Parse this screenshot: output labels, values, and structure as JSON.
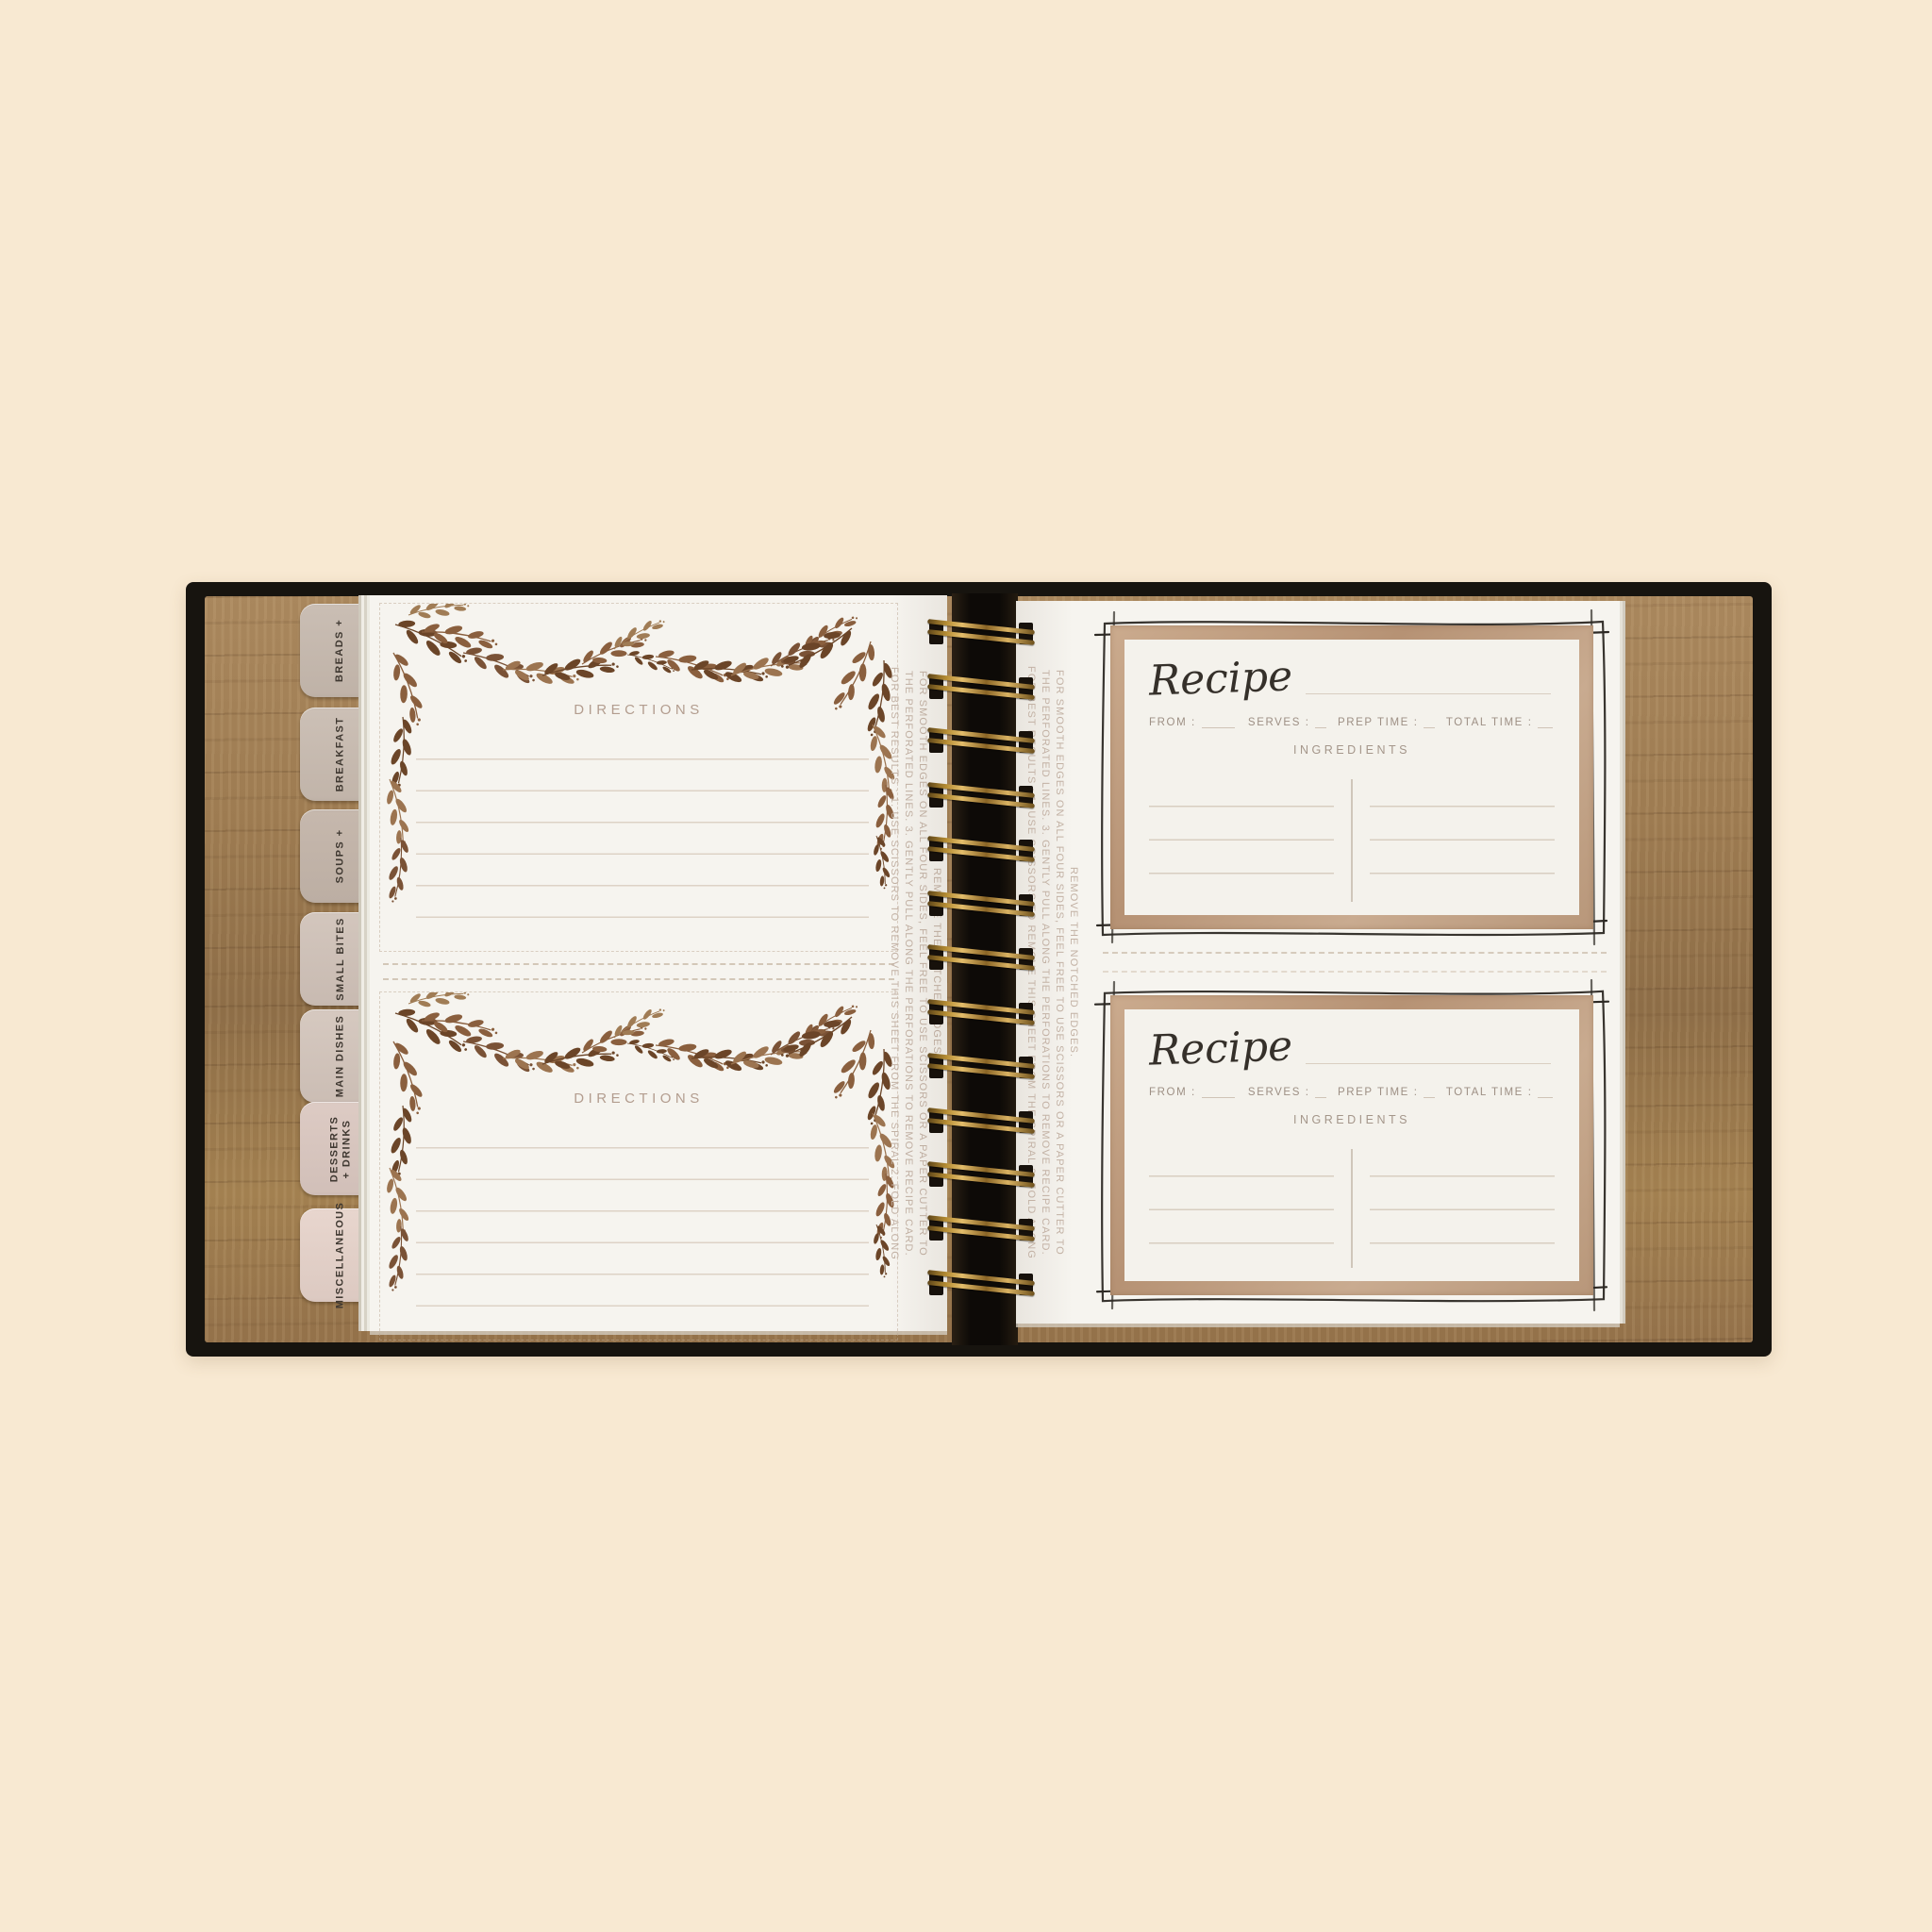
{
  "tabs": [
    {
      "label": "BREADS +"
    },
    {
      "label": "BREAKFAST"
    },
    {
      "label": "SOUPS +"
    },
    {
      "label": "SMALL BITES"
    },
    {
      "label": "MAIN DISHES"
    },
    {
      "label": "DESSERTS\n+ DRINKS"
    },
    {
      "label": "MISCELLANEOUS"
    }
  ],
  "left_page": {
    "directions_label": "DIRECTIONS"
  },
  "recipe_card": {
    "title": "Recipe",
    "from_label": "FROM :",
    "serves_label": "SERVES :",
    "prep_label": "PREP TIME :",
    "total_label": "TOTAL TIME :",
    "ingredients_label": "INGREDIENTS"
  },
  "instructions": {
    "lines": [
      "FOR BEST RESULTS : 1. USE SCISSORS TO REMOVE THIS SHEET FROM THE SPIRAL 2. FOLD ALONG",
      "THE PERFORATED LINES. 3. GENTLY PULL ALONG THE PERFORATIONS TO REMOVE RECIPE CARD.",
      "FOR SMOOTH EDGES ON ALL FOUR SIDES, FEEL FREE TO USE SCISSORS OR A PAPER CUTTER TO",
      "REMOVE THE NOTCHED EDGES."
    ]
  },
  "spiral": {
    "coil_count": 13
  },
  "colors": {
    "background": "#f8e9d2",
    "cover": "#17140f",
    "wood": "#9b7850",
    "page": "#f6f4ef",
    "tan_frame": "#c2a083",
    "brass_wire": "#d9b262",
    "ink_sketch": "#2d2924",
    "muted_label": "#a4968a",
    "leaf_brown": "#6b4528"
  }
}
